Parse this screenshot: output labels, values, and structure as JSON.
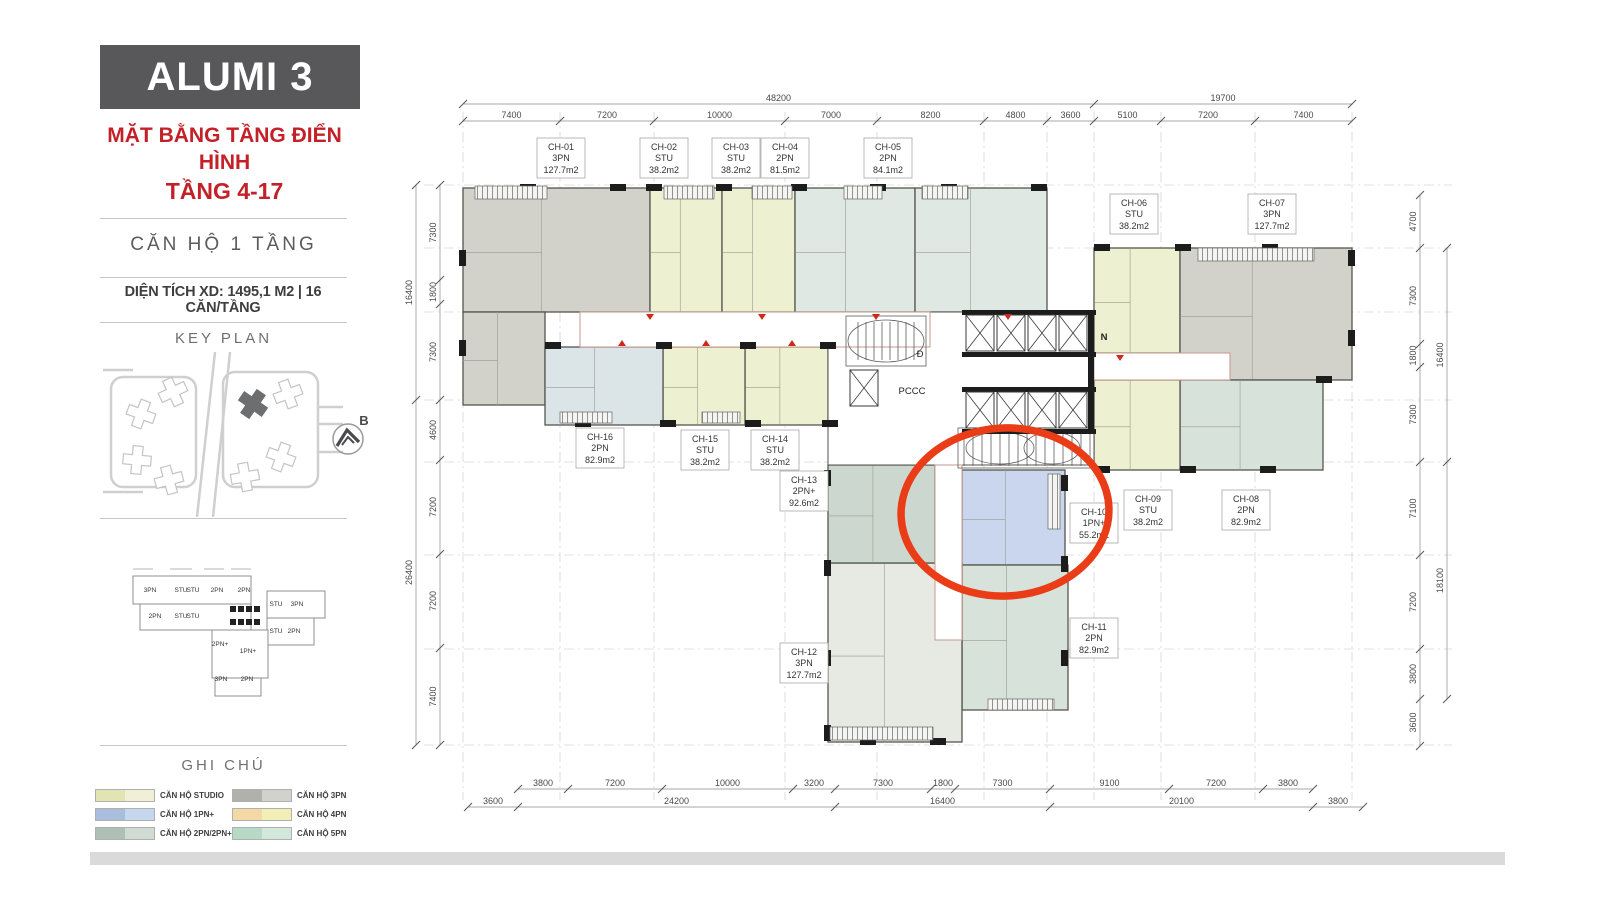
{
  "colors": {
    "accent_red": "#c32128",
    "highlight_red": "#e93c17",
    "title_bg": "#58585a",
    "footer_bar": "#dadada"
  },
  "sidebar": {
    "title": "ALUMI 3",
    "subtitle_line1": "MẶT BẰNG TẦNG ĐIỂN HÌNH",
    "subtitle_line2": "TẦNG 4-17",
    "unit_type": "CĂN HỘ 1 TẦNG",
    "area_info": "DIỆN TÍCH XD: 1495,1 M2  |  16 CĂN/TẦNG",
    "key_plan_title": "KEY PLAN",
    "compass_label": "B",
    "legend_title": "GHI CHÚ",
    "legend": [
      {
        "label": "CĂN HỘ STUDIO",
        "color_dark": "#e2e4b4",
        "color_light": "#eff0d6"
      },
      {
        "label": "CĂN HỘ 1PN+",
        "color_dark": "#a9bedd",
        "color_light": "#c6d6ec"
      },
      {
        "label": "CĂN HỘ 2PN/2PN+",
        "color_dark": "#aebfb6",
        "color_light": "#d0dcd3"
      },
      {
        "label": "CĂN HỘ 3PN",
        "color_dark": "#b1b1ac",
        "color_light": "#d2d2cd"
      },
      {
        "label": "CĂN HỘ 4PN",
        "color_dark": "#f4d9a7",
        "color_light": "#f2efb6"
      },
      {
        "label": "CĂN HỘ 5PN",
        "color_dark": "#b6dac6",
        "color_light": "#d2e8db"
      }
    ],
    "mini_plan_labels": [
      "3PN",
      "STU",
      "STU",
      "2PN",
      "2PN",
      "STU",
      "3PN",
      "2PN",
      "STU",
      "STU",
      "STU",
      "2PN",
      "2PN+",
      "1PN+",
      "3PN",
      "2PN"
    ]
  },
  "floor_plan": {
    "core_labels": {
      "pccc": "PCCC",
      "d": "Đ",
      "n": "N"
    },
    "units": [
      {
        "id": "CH-01",
        "type": "3PN",
        "area": "127.7m2",
        "color": "#d2d2ca"
      },
      {
        "id": "CH-02",
        "type": "STU",
        "area": "38.2m2",
        "color": "#eef0d2"
      },
      {
        "id": "CH-03",
        "type": "STU",
        "area": "38.2m2",
        "color": "#eef0d2"
      },
      {
        "id": "CH-04",
        "type": "2PN",
        "area": "81.5m2",
        "color": "#dfe8e3"
      },
      {
        "id": "CH-05",
        "type": "2PN",
        "area": "84.1m2",
        "color": "#dfe8e3"
      },
      {
        "id": "CH-06",
        "type": "STU",
        "area": "38.2m2",
        "color": "#eef0d2"
      },
      {
        "id": "CH-07",
        "type": "3PN",
        "area": "127.7m2",
        "color": "#d2d2ca"
      },
      {
        "id": "CH-08",
        "type": "2PN",
        "area": "82.9m2",
        "color": "#d7e3da"
      },
      {
        "id": "CH-09",
        "type": "STU",
        "area": "38.2m2",
        "color": "#eef0d2"
      },
      {
        "id": "CH-10",
        "type": "1PN+",
        "area": "55.2m2",
        "color": "#c9d6ee",
        "highlighted": true
      },
      {
        "id": "CH-11",
        "type": "2PN",
        "area": "82.9m2",
        "color": "#d7e3da"
      },
      {
        "id": "CH-12",
        "type": "3PN",
        "area": "127.7m2",
        "color": "#e6eae2"
      },
      {
        "id": "CH-13",
        "type": "2PN+",
        "area": "92.6m2",
        "color": "#ccd8cf"
      },
      {
        "id": "CH-14",
        "type": "STU",
        "area": "38.2m2",
        "color": "#eef0d2"
      },
      {
        "id": "CH-15",
        "type": "STU",
        "area": "38.2m2",
        "color": "#eef0d2"
      },
      {
        "id": "CH-16",
        "type": "2PN",
        "area": "82.9m2",
        "color": "#dbe4e6"
      }
    ],
    "dimensions": {
      "top_outer": [
        "48200",
        "19700"
      ],
      "top_inner": [
        "7400",
        "7200",
        "10000",
        "7000",
        "8200",
        "4800",
        "3600",
        "5100",
        "7200",
        "7400"
      ],
      "bottom_inner": [
        "3800",
        "7200",
        "10000",
        "3200",
        "7300",
        "1800",
        "7300",
        "9100",
        "7200",
        "3800"
      ],
      "bottom_outer": [
        "3600",
        "24200",
        "16400",
        "20100",
        "3800"
      ],
      "left_inner": [
        "7300",
        "1800",
        "7300",
        "4600",
        "7200",
        "7200",
        "7400"
      ],
      "left_outer": [
        "16400",
        "26400"
      ],
      "right_inner": [
        "4700",
        "7300",
        "1800",
        "7300",
        "7100",
        "7200",
        "3800",
        "3600"
      ],
      "right_outer": [
        "16400",
        "18100"
      ]
    }
  }
}
